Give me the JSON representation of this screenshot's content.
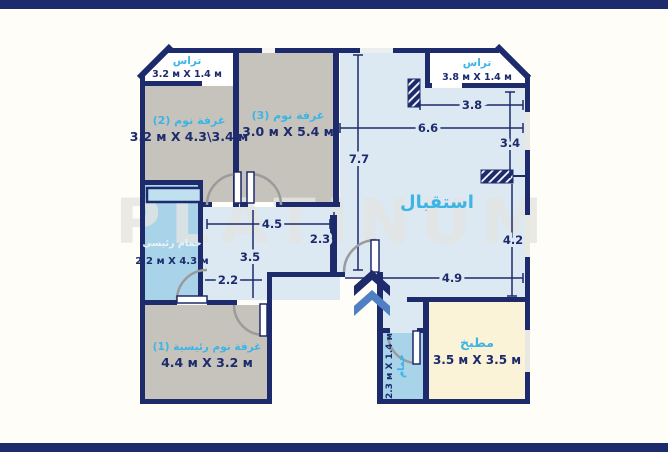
{
  "watermark": "PLATINUM",
  "rooms": {
    "terrace_left": {
      "name": "تراس",
      "dims": "3.2 м X 1.4 м"
    },
    "terrace_right": {
      "name": "تراس",
      "dims": "3.8 м X 1.4 м"
    },
    "bedroom2": {
      "name": "غرفة نوم (2)",
      "dims": "3.2 м X 4.3\\3.4 м"
    },
    "bedroom3": {
      "name": "غرفة نوم (3)",
      "dims": "3.0 м X 5.4 м"
    },
    "reception": {
      "name": "استقبال"
    },
    "main_bathroom": {
      "name": "حمام رئيسي",
      "dims": "2.2 м X 4.3 м"
    },
    "master_bedroom": {
      "name": "غرفة نوم رئيسية (1)",
      "dims": "4.4 м X 3.2 м"
    },
    "kitchen": {
      "name": "مطبخ",
      "dims": "3.5 м X 3.5 м"
    },
    "small_bathroom": {
      "name": "حمام",
      "dims": "2.3 м X 1.4 м"
    }
  },
  "dimensions": {
    "terrace_right_width": "3.8",
    "reception_width": "6.6",
    "reception_height": "7.7",
    "right_upper": "3.4",
    "right_lower": "4.2",
    "reception_bottom_width": "4.9",
    "hall_width": "4.5",
    "hall_depth": "2.3",
    "corridor_length": "3.5",
    "corridor_width": "2.2"
  },
  "colors": {
    "wall_navy": "#1d2b6c",
    "room_gray": "#c6c3bd",
    "floor_blue": "#dce8f2",
    "bath_blue": "#a9d3e9",
    "kitchen_cream": "#faf3d8",
    "label_cyan": "#3cb4e5",
    "arrow_blue": "#4f80c4"
  }
}
